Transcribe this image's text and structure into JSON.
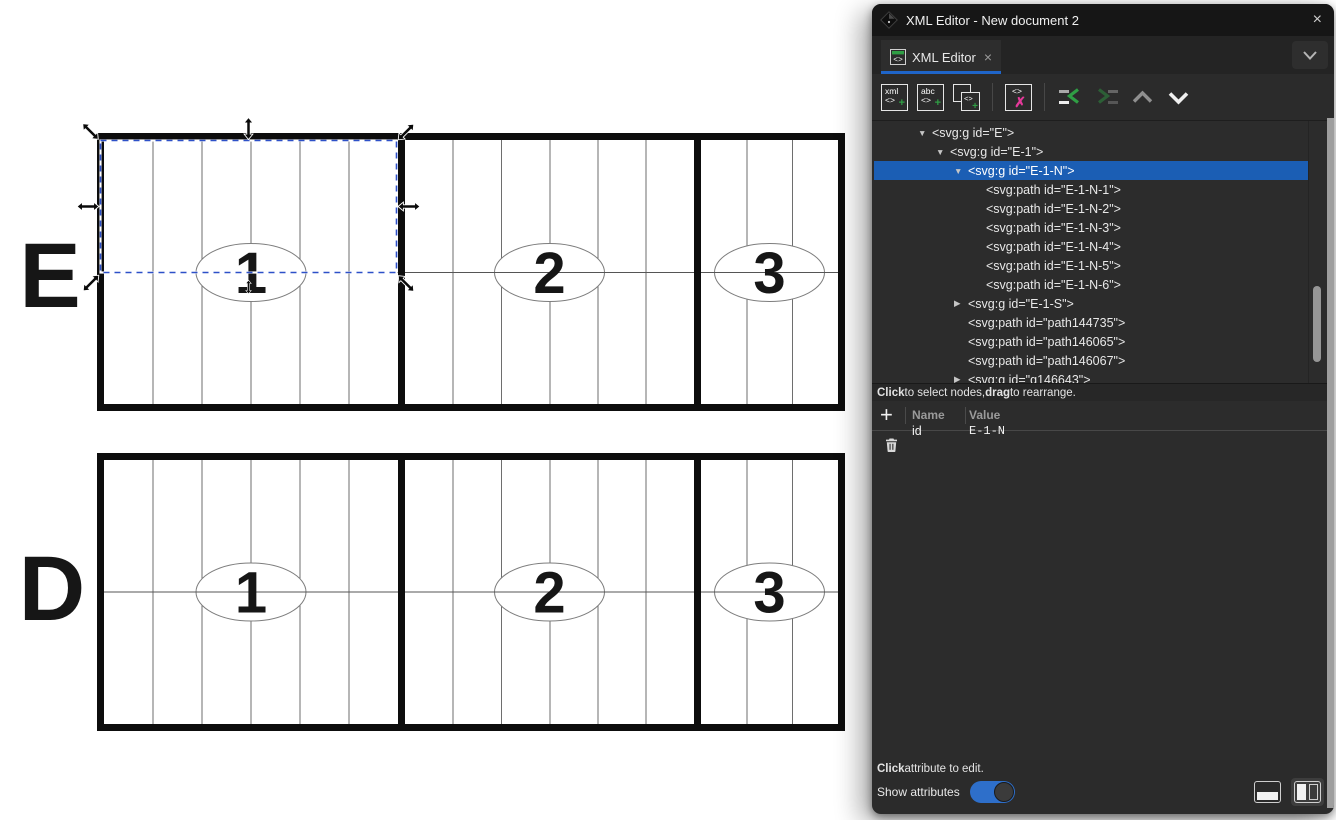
{
  "window": {
    "title": "XML Editor - New document 2",
    "close_label": "×"
  },
  "tab": {
    "label": "XML Editor",
    "close_label": "×"
  },
  "toolbar": {
    "new_element": {
      "line1": "xml",
      "line2": "<>",
      "plus": "+"
    },
    "new_text": {
      "line1": "abc",
      "line2": "<>",
      "plus": "+"
    },
    "duplicate": {
      "glyph": "<>",
      "plus": "+"
    },
    "delete": {
      "glyph": "<>",
      "x": "✗"
    }
  },
  "tree": {
    "nodes": [
      {
        "indent": 0,
        "toggle": "open",
        "selected": false,
        "label": "<svg:g id=\"E\">"
      },
      {
        "indent": 1,
        "toggle": "open",
        "selected": false,
        "label": "<svg:g id=\"E-1\">"
      },
      {
        "indent": 2,
        "toggle": "open",
        "selected": true,
        "label": "<svg:g id=\"E-1-N\">"
      },
      {
        "indent": 3,
        "toggle": null,
        "selected": false,
        "label": "<svg:path id=\"E-1-N-1\">"
      },
      {
        "indent": 3,
        "toggle": null,
        "selected": false,
        "label": "<svg:path id=\"E-1-N-2\">"
      },
      {
        "indent": 3,
        "toggle": null,
        "selected": false,
        "label": "<svg:path id=\"E-1-N-3\">"
      },
      {
        "indent": 3,
        "toggle": null,
        "selected": false,
        "label": "<svg:path id=\"E-1-N-4\">"
      },
      {
        "indent": 3,
        "toggle": null,
        "selected": false,
        "label": "<svg:path id=\"E-1-N-5\">"
      },
      {
        "indent": 3,
        "toggle": null,
        "selected": false,
        "label": "<svg:path id=\"E-1-N-6\">"
      },
      {
        "indent": 2,
        "toggle": "closed",
        "selected": false,
        "label": "<svg:g id=\"E-1-S\">"
      },
      {
        "indent": 2,
        "toggle": null,
        "selected": false,
        "label": "<svg:path id=\"path144735\">"
      },
      {
        "indent": 2,
        "toggle": null,
        "selected": false,
        "label": "<svg:path id=\"path146065\">"
      },
      {
        "indent": 2,
        "toggle": null,
        "selected": false,
        "label": "<svg:path id=\"path146067\">"
      },
      {
        "indent": 2,
        "toggle": "closed",
        "selected": false,
        "label": "<svg:g id=\"g146643\">"
      }
    ],
    "hint_parts": [
      "Click",
      " to select nodes, ",
      "drag",
      " to rearrange."
    ]
  },
  "attributes": {
    "add_label": "+",
    "columns": [
      "Name",
      "Value"
    ],
    "rows": [
      {
        "name": "id",
        "value": "E-1-N"
      }
    ],
    "hint_parts": [
      "Click",
      " attribute to edit."
    ],
    "show_attributes_label": "Show attributes",
    "toggle_on": true
  },
  "canvas": {
    "rows": [
      {
        "letter": "E",
        "cells": [
          "1",
          "2",
          "3"
        ],
        "selected_cell": "E-1-N"
      },
      {
        "letter": "D",
        "cells": [
          "1",
          "2",
          "3"
        ],
        "selected_cell": null
      }
    ]
  },
  "colors": {
    "selection_blue": "#1b5eb4",
    "tab_underline": "#1f65c9",
    "toggle_blue": "#2e6fca",
    "icon_green": "#2f9e44",
    "icon_magenta": "#e5399b",
    "dash_blue": "#2d50c8"
  }
}
